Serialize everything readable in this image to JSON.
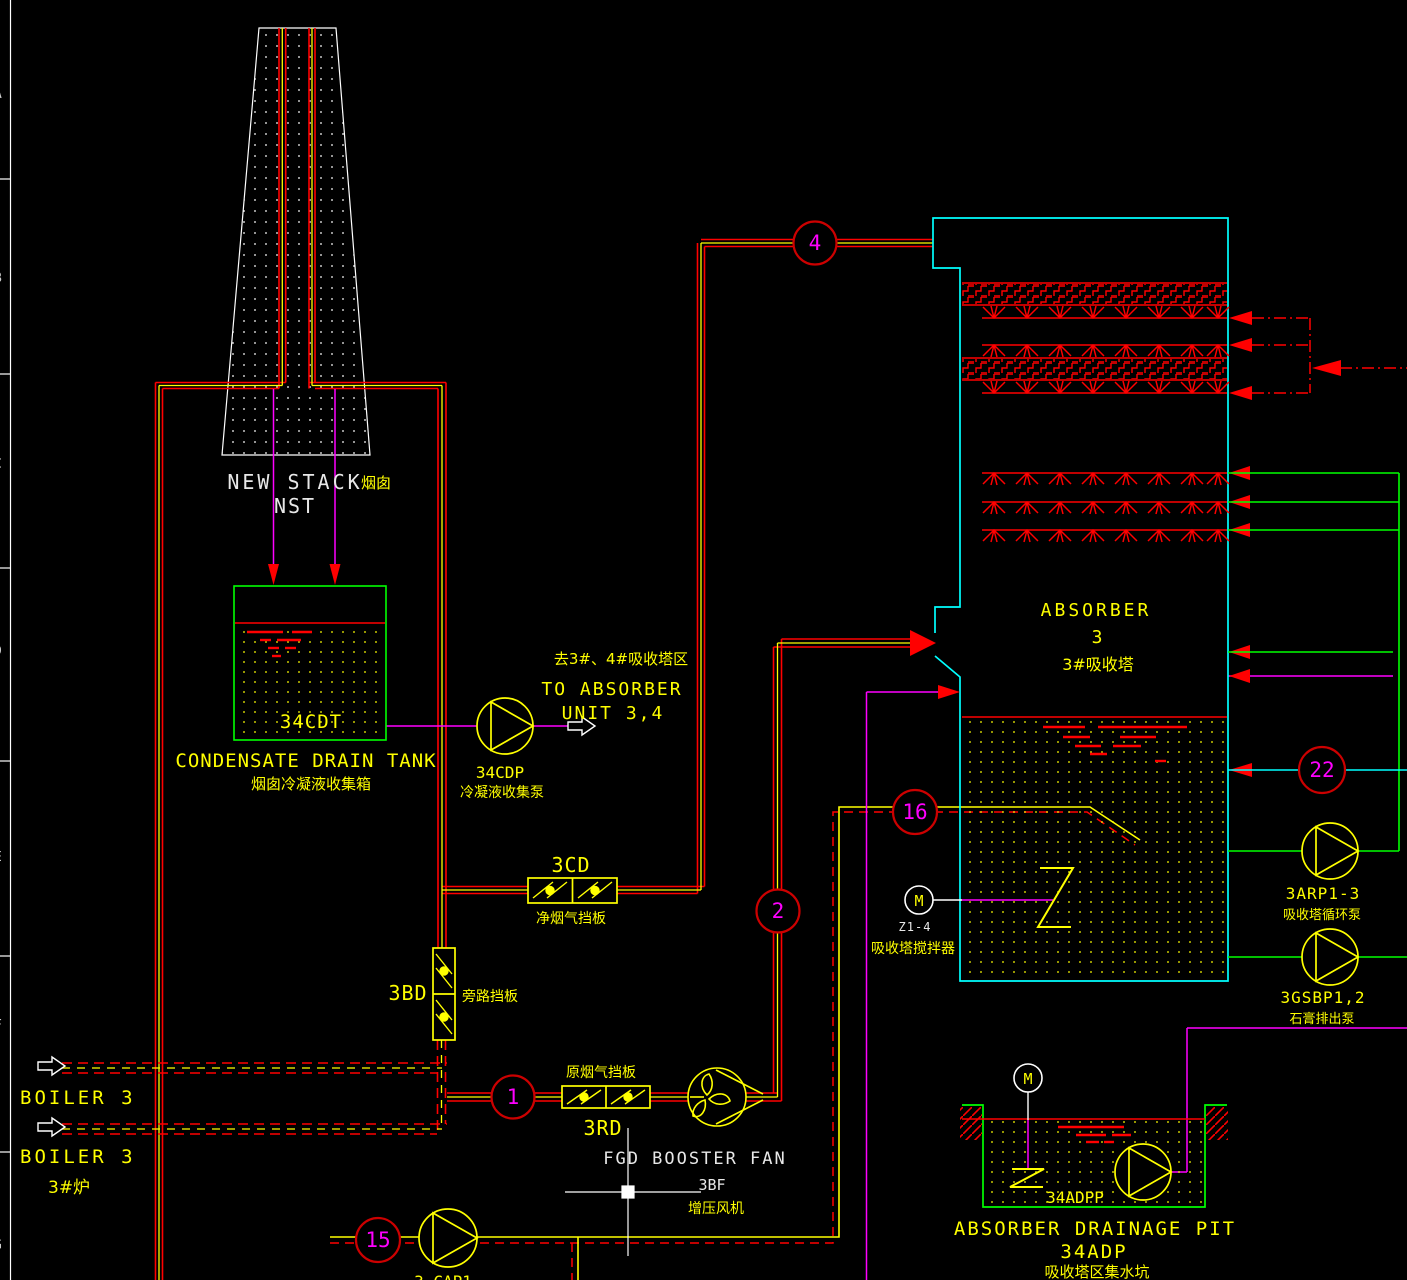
{
  "colors": {
    "background": "#000000",
    "duct_red": "#ff0000",
    "center_yellow": "#ffff00",
    "equipment_yellow": "#ffff00",
    "process_magenta": "#ff00ff",
    "slurry_green": "#00ff00",
    "vessel_cyan": "#00ffff",
    "annotation_white": "#ffffff"
  },
  "border": {
    "rows": [
      "A",
      "B",
      "C",
      "D",
      "E",
      "F",
      "G"
    ]
  },
  "stack": {
    "name_en": "NEW STACK",
    "name_cn": "烟囱",
    "code": "NST"
  },
  "tank": {
    "code": "34CDT",
    "name_en": "CONDENSATE DRAIN TANK",
    "name_cn": "烟囱冷凝液收集箱"
  },
  "cdp_pump": {
    "code": "34CDP",
    "name_cn": "冷凝液收集泵"
  },
  "route_out": {
    "line_cn": "去3#、4#吸收塔区",
    "line1": "TO ABSORBER",
    "line2": "UNIT 3,4"
  },
  "dampers": {
    "cd": {
      "code": "3CD",
      "name_cn": "净烟气挡板"
    },
    "bd": {
      "code": "3BD",
      "name_cn": "旁路挡板"
    },
    "rd": {
      "code": "3RD",
      "name_cn": "原烟气挡板"
    }
  },
  "boiler": {
    "label1": "BOILER 3",
    "label2": "BOILER 3",
    "unit_cn": "3#炉"
  },
  "fan": {
    "name_en": "FGD BOOSTER FAN",
    "code": "3BF",
    "name_cn": "增压风机"
  },
  "absorber": {
    "name_en": "ABSORBER",
    "number": "3",
    "name_cn": "3#吸收塔"
  },
  "agitator": {
    "motor": "M",
    "code": "Z1-4",
    "name_cn": "吸收塔搅拌器"
  },
  "arp_pump": {
    "code": "3ARP1-3",
    "name_cn": "吸收塔循环泵"
  },
  "gsbp_pump": {
    "code": "3GSBP1,2",
    "name_cn": "石膏排出泵"
  },
  "pit": {
    "motor": "M",
    "pump_code": "34ADPP",
    "name_en": "ABSORBER DRAINAGE PIT",
    "code": "34ADP",
    "name_cn": "吸收塔区集水坑"
  },
  "cap_pump": {
    "code": "3-CAP1"
  },
  "stream_tags": {
    "t1": "1",
    "t2": "2",
    "t4": "4",
    "t15": "15",
    "t16": "16",
    "t22": "22"
  }
}
